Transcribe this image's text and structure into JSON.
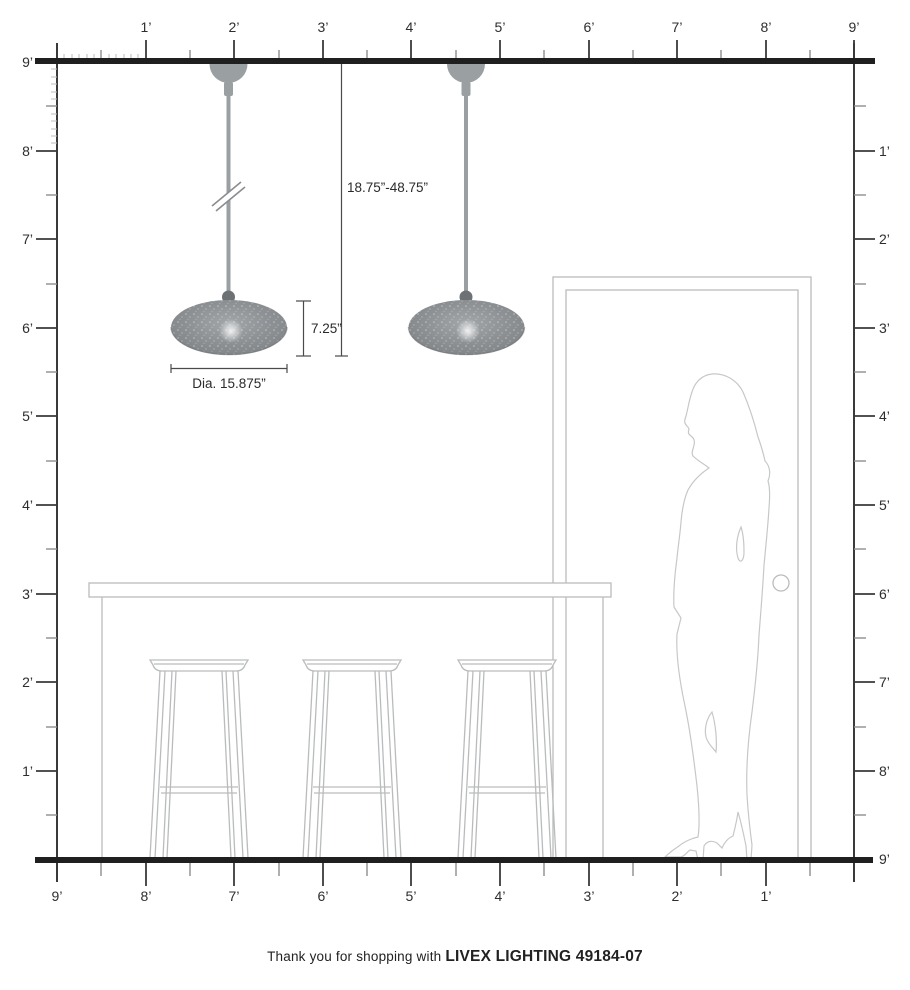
{
  "page": {
    "background": "#ffffff"
  },
  "footer": {
    "prefix": "Thank you for shopping with ",
    "brand": "LIVEX LIGHTING 49184-07"
  },
  "annotations": {
    "hang_range": "18.75”-48.75”",
    "shade_height": "7.25”",
    "shade_diameter": "Dia. 15.875”"
  },
  "rulers": {
    "unit": "feet",
    "top": [
      "1’",
      "2’",
      "3’",
      "4’",
      "5’",
      "6’",
      "7’",
      "8’",
      "9’"
    ],
    "left": [
      "9’",
      "8’",
      "7’",
      "6’",
      "5’",
      "4’",
      "3’",
      "2’",
      "1’"
    ],
    "right": [
      "1’",
      "2’",
      "3’",
      "4’",
      "5’",
      "6’",
      "7’",
      "8’",
      "9’"
    ],
    "bottom": [
      "9’",
      "8’",
      "7’",
      "6’",
      "5’",
      "4’",
      "3’",
      "2’",
      "1’"
    ]
  },
  "scene": {
    "fixture_count": 2,
    "items": [
      "pendant-light",
      "pendant-light",
      "hang-rod-break-mark",
      "bar-counter",
      "bar-stool",
      "bar-stool",
      "bar-stool",
      "door-frame",
      "door-knob",
      "woman-silhouette"
    ]
  },
  "colors": {
    "structure_line": "#1f1f1f",
    "ruler_text": "#2e2e2e",
    "tick_minor": "#8f8f8f",
    "furniture_line": "#b9bcbd",
    "figure_line": "#c6c8c8",
    "shade_gray": "#8b8f92",
    "hardware_gray": "#9aa0a2",
    "ball_gray": "#6e7173"
  }
}
